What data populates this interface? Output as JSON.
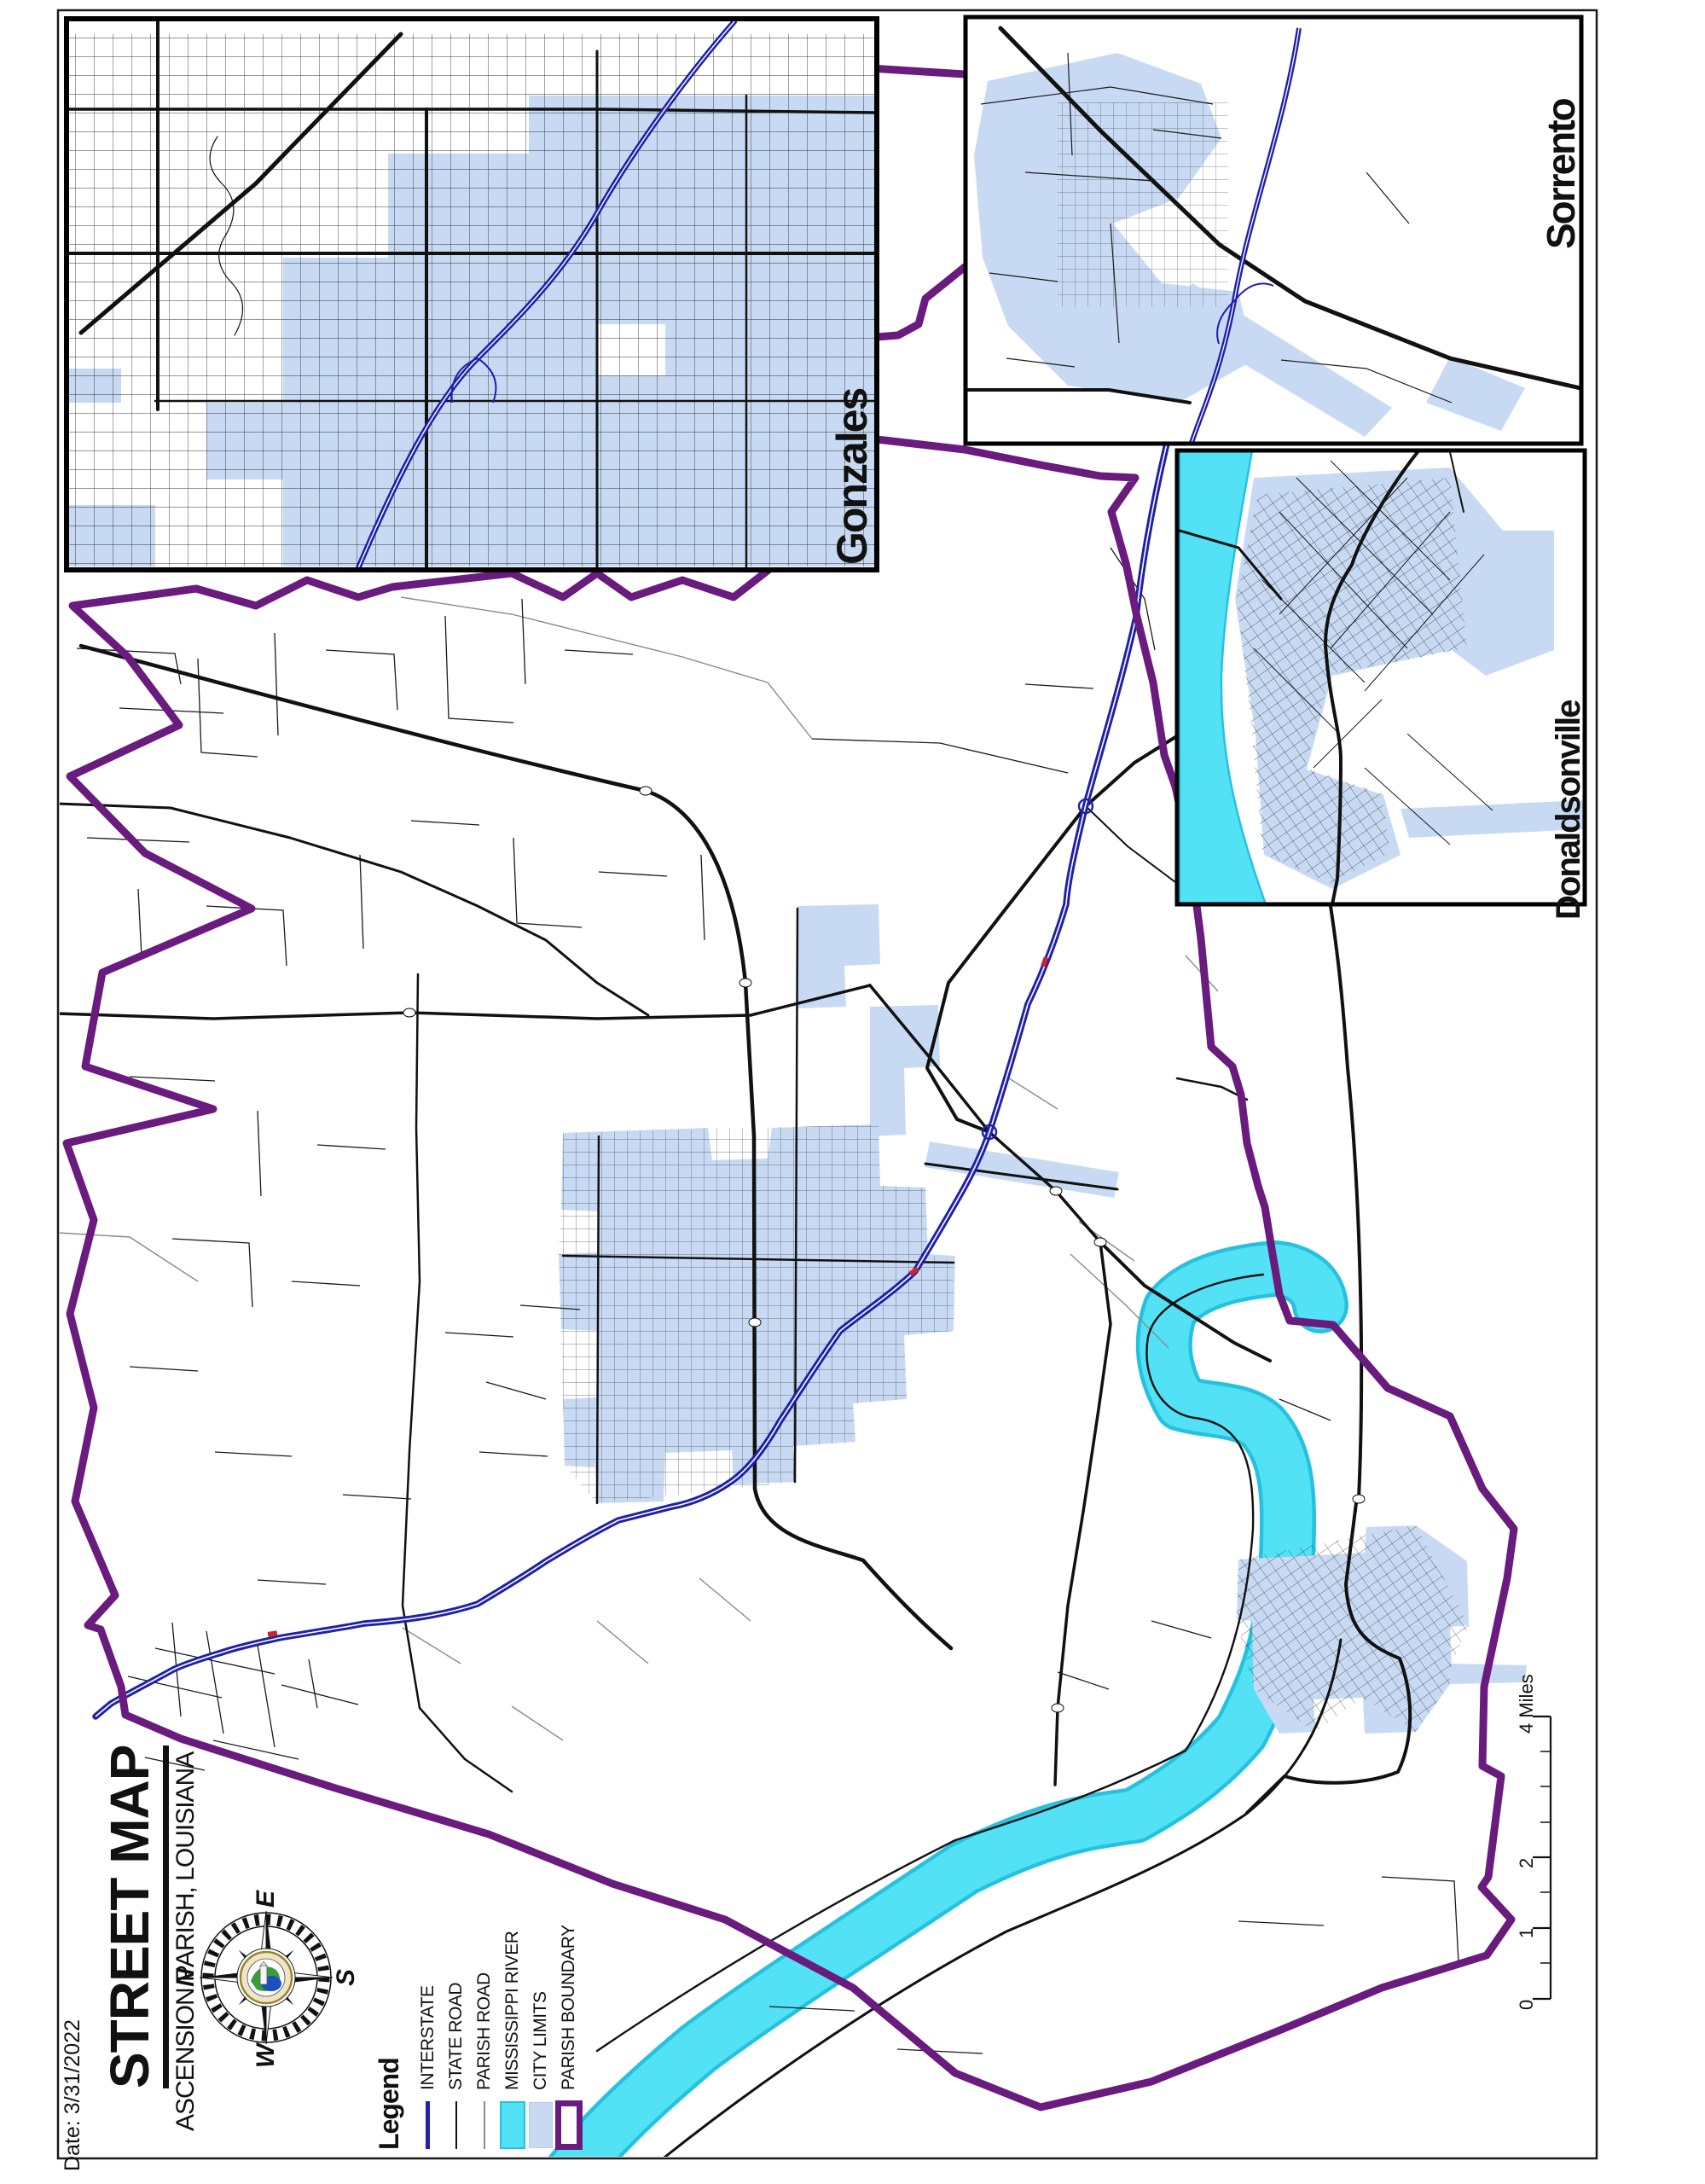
{
  "page": {
    "title": "STREET MAP",
    "subtitle": "ASCENSION PARISH, LOUISIANA",
    "date_label": "Date: 3/31/2022"
  },
  "legend": {
    "heading": "Legend",
    "items": [
      {
        "id": "interstate",
        "label": "INTERSTATE",
        "symbol": "blue-line"
      },
      {
        "id": "state-road",
        "label": "STATE ROAD",
        "symbol": "black-line"
      },
      {
        "id": "parish-road",
        "label": "PARISH ROAD",
        "symbol": "gray-line"
      },
      {
        "id": "mississippi-river",
        "label": "MISSISSIPPI RIVER",
        "symbol": "cyan-swatch"
      },
      {
        "id": "city-limits",
        "label": "CITY LIMITS",
        "symbol": "lightblue-swatch"
      },
      {
        "id": "parish-boundary",
        "label": "PARISH BOUNDARY",
        "symbol": "purple-outline"
      }
    ]
  },
  "compass": {
    "north": "N",
    "east": "E",
    "south": "S",
    "west": "W"
  },
  "insets": [
    {
      "name": "Gonzales"
    },
    {
      "name": "Sorrento"
    },
    {
      "name": "Donaldsonville"
    }
  ],
  "scale_bar": {
    "tick_labels": [
      "0",
      "1",
      "2"
    ],
    "end_label": "4 Miles"
  },
  "colors": {
    "boundary": "#691B7E",
    "interstate": "#2020A8",
    "river": "#53E1F5",
    "river_edge": "#25C2E0",
    "city": "#C8DAF3",
    "road": "#111111",
    "parish_road": "#8A8A8A"
  }
}
